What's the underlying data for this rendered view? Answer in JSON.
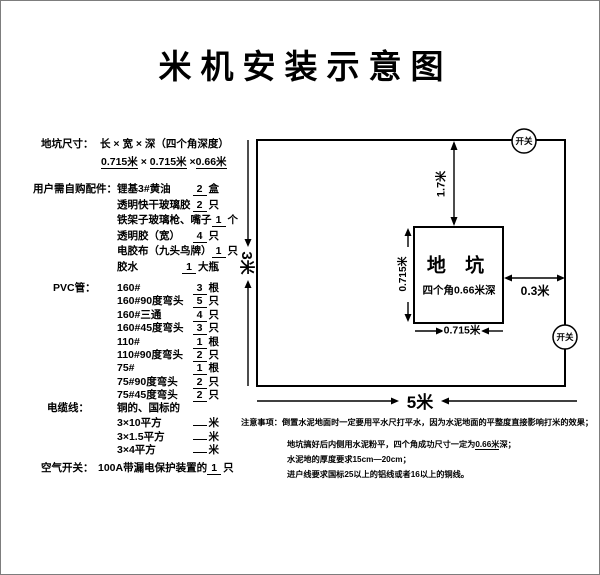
{
  "title": "米机安装示意图",
  "spec": {
    "label": "地坑尺寸：",
    "formula": "长 × 宽 × 深（四个角深度）",
    "v1": "0.715米",
    "sep1": "×",
    "v2": "0.715米",
    "sep2": "×",
    "v3": "0.66米"
  },
  "parts": {
    "label": "用户需自购配件：",
    "items": [
      {
        "name": "锂基3#黄油",
        "qty": "2",
        "unit": "盒"
      },
      {
        "name": "透明快干玻璃胶",
        "qty": "2",
        "unit": "只"
      },
      {
        "name": "铁架子玻璃枪、嘴子",
        "qty": "1",
        "unit": "个"
      },
      {
        "name": "透明胶（宽）",
        "qty": "4",
        "unit": "只"
      },
      {
        "name": "电胶布（九头鸟牌）",
        "qty": "1",
        "unit": "只"
      },
      {
        "name": "胶水",
        "qty": "1",
        "unit": "大瓶"
      }
    ]
  },
  "pvc": {
    "label": "PVC管：",
    "items": [
      {
        "name": "160#",
        "qty": "3",
        "unit": "根"
      },
      {
        "name": "160#90度弯头",
        "qty": "5",
        "unit": "只"
      },
      {
        "name": "160#三通",
        "qty": "4",
        "unit": "只"
      },
      {
        "name": "160#45度弯头",
        "qty": "3",
        "unit": "只"
      },
      {
        "name": "110#",
        "qty": "1",
        "unit": "根"
      },
      {
        "name": "110#90度弯头",
        "qty": "2",
        "unit": "只"
      },
      {
        "name": "75#",
        "qty": "1",
        "unit": "根"
      },
      {
        "name": "75#90度弯头",
        "qty": "2",
        "unit": "只"
      },
      {
        "name": "75#45度弯头",
        "qty": "2",
        "unit": "只"
      }
    ]
  },
  "cable": {
    "label": "电缆线：",
    "spec_note": "铜的、国标的",
    "items": [
      {
        "name": "3×10平方",
        "qty": "",
        "unit": "米"
      },
      {
        "name": "3×1.5平方",
        "qty": "",
        "unit": "米"
      },
      {
        "name": "3×4平方",
        "qty": "",
        "unit": "米"
      }
    ]
  },
  "breaker": {
    "label": "空气开关：",
    "desc": "100A带漏电保护装置的",
    "qty": "1",
    "unit": "只"
  },
  "diagram": {
    "room_width": "5米",
    "room_height": "3米",
    "pit_top_gap": "1.7米",
    "pit_right_gap": "0.3米",
    "pit_title": "地 坑",
    "pit_depth": "四个角0.66米深",
    "pit_width": "0.715米",
    "pit_height": "0.715米",
    "switch_top": "开关",
    "switch_right": "开关"
  },
  "notes": {
    "label": "注意事项：",
    "line1": "倒置水泥地面时一定要用平水尺打平水，因为水泥地面的平整度直接影响打米的效果；",
    "line2_pre": "地坑搞好后内侧用水泥粉平，四个角成功尺寸一定为",
    "line2_u": "0.66米",
    "line2_post": "深；",
    "line3": "水泥地的厚度要求15cm—20cm；",
    "line4": "进户线要求国标25以上的铝线或者16以上的铜线。"
  }
}
